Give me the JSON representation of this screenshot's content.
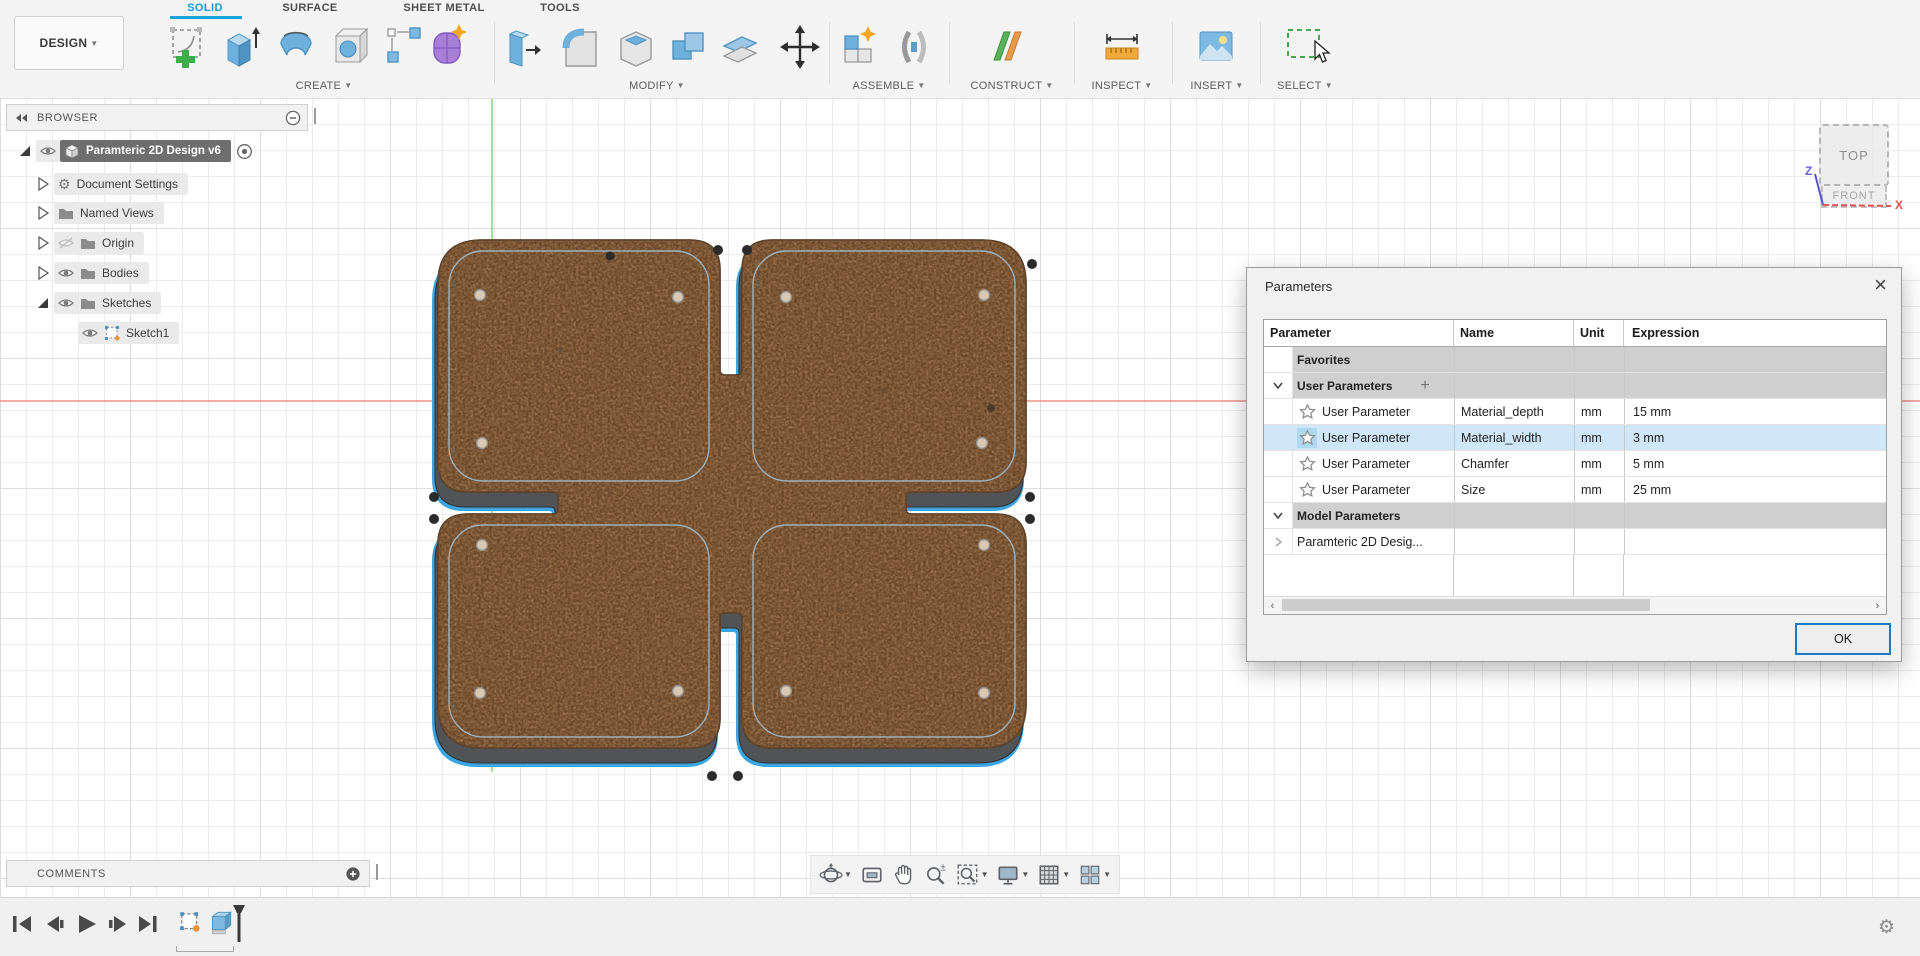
{
  "app": {
    "design_label": "DESIGN",
    "tabs": [
      "SOLID",
      "SURFACE",
      "SHEET METAL",
      "TOOLS"
    ],
    "active_tab": "SOLID",
    "groups": [
      {
        "label": "CREATE"
      },
      {
        "label": "MODIFY"
      },
      {
        "label": "ASSEMBLE"
      },
      {
        "label": "CONSTRUCT"
      },
      {
        "label": "INSPECT"
      },
      {
        "label": "INSERT"
      },
      {
        "label": "SELECT"
      }
    ]
  },
  "browser": {
    "title": "BROWSER",
    "root": "Paramteric 2D Design v6",
    "items": [
      "Document Settings",
      "Named Views",
      "Origin",
      "Bodies",
      "Sketches",
      "Sketch1"
    ]
  },
  "comments": {
    "title": "COMMENTS"
  },
  "viewcube": {
    "top": "TOP",
    "front": "FRONT",
    "axis_x": "X",
    "axis_z": "Z"
  },
  "dialog": {
    "title": "Parameters",
    "columns": [
      "Parameter",
      "Name",
      "Unit",
      "Expression"
    ],
    "sections": {
      "favorites": "Favorites",
      "user": "User Parameters",
      "model": "Model Parameters",
      "model_child": "Paramteric 2D Desig..."
    },
    "rows": [
      {
        "param": "User Parameter",
        "name": "Material_depth",
        "unit": "mm",
        "expression": "15 mm"
      },
      {
        "param": "User Parameter",
        "name": "Material_width",
        "unit": "mm",
        "expression": "3 mm"
      },
      {
        "param": "User Parameter",
        "name": "Chamfer",
        "unit": "mm",
        "expression": "5 mm"
      },
      {
        "param": "User Parameter",
        "name": "Size",
        "unit": "mm",
        "expression": "25 mm"
      }
    ],
    "selected_row": "Material_width",
    "ok_label": "OK"
  },
  "colors": {
    "accent_blue": "#0f9bd7",
    "selection_blue": "#3aa5e3",
    "wood_base": "#c89d72",
    "axis_red": "#ef9089",
    "axis_green": "#86d986",
    "row_selected": "#cfe7f8",
    "section_gray": "#cfcfcf",
    "ok_border": "#1f7ac4"
  }
}
